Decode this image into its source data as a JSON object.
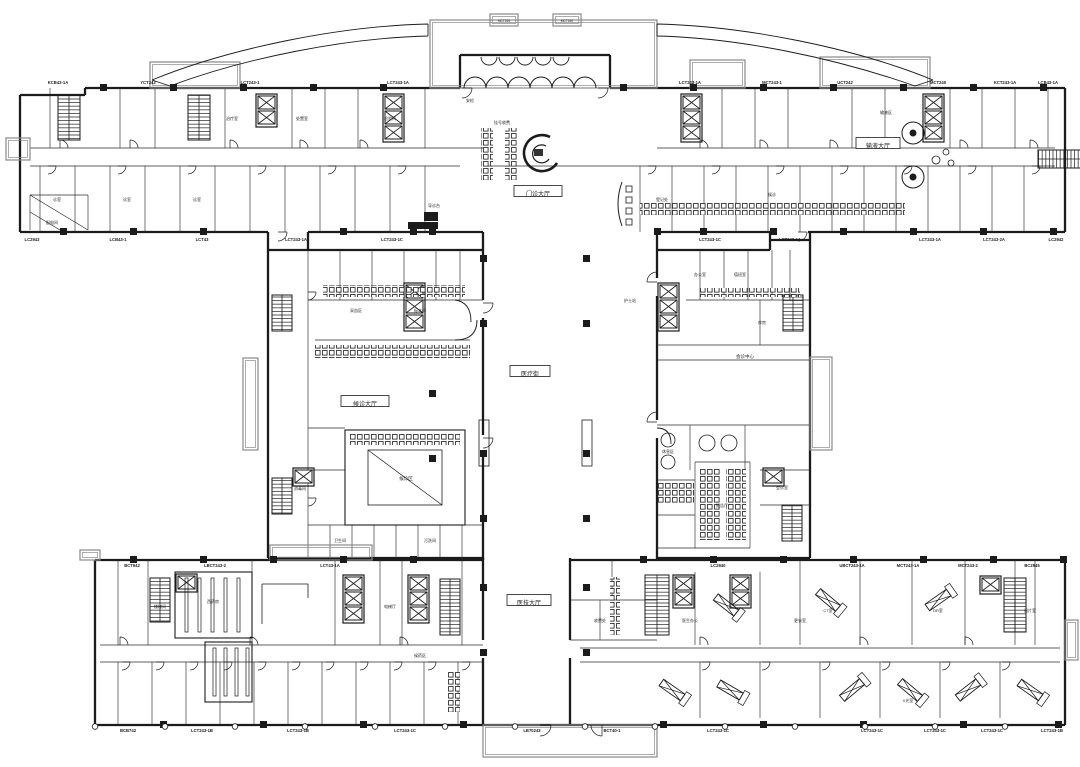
{
  "drawing": {
    "type_label": "医院首层平面图",
    "halls": [
      "门诊大厅",
      "医疗街",
      "医技大厅",
      "输液大厅",
      "候诊大厅",
      "会诊中心",
      "候诊区"
    ],
    "spiral_label": "服务台",
    "canopy_boxes": [
      "MCT240",
      "MCT240"
    ],
    "grid_labels": {
      "top": [
        "KCB43-1A",
        "YCT242",
        "LCT243-1",
        "LCT243-1A",
        "LCT243-1A",
        "MCT243-1",
        "UCT242",
        "MCT240",
        "KCT243-1A",
        "LCB43-1A"
      ],
      "upper_bottom": [
        "LC2943",
        "LCB43-1",
        "LCT43",
        "LCT243-1A",
        "LCT243-1C",
        "LCT243-1C",
        "LCT243-1A",
        "LCT243-1A",
        "LCT243-2A",
        "LC2942"
      ],
      "lower_top": [
        "BCT942",
        "LBCT243-2",
        "LCT43-1A",
        "LC2940",
        "UBCT243-1A",
        "MCT243-1A",
        "MCT243-2",
        "BC2945"
      ],
      "bottom": [
        "BCB742",
        "LCT243-1B",
        "LCT243-1B",
        "LCT243-1C",
        "LB70243",
        "BCT40-1",
        "LCT243-1C",
        "LCT243-1C",
        "LCT243-1C",
        "LCT243-1C",
        "LCT243-1B"
      ]
    },
    "room_labels": [
      "诊室",
      "诊室",
      "诊室",
      "候诊",
      "西药房",
      "治疗室",
      "处置室",
      "护士站",
      "输液区",
      "挂号收费",
      "卫生间",
      "污洗间",
      "库房",
      "办公室",
      "值班室",
      "配电间",
      "登记处",
      "报告厅",
      "会诊室",
      "CT室",
      "DR室",
      "X光室",
      "更衣室",
      "阅片室",
      "医生办公",
      "检验科",
      "采血区",
      "标本间",
      "消毒间",
      "候药区",
      "电梯厅",
      "楼梯间",
      "导诊台",
      "收费处",
      "安检",
      "休息区"
    ]
  },
  "colors": {
    "ink": "#1b1b1b",
    "light": "#8a8a8a",
    "paper": "#ffffff"
  }
}
